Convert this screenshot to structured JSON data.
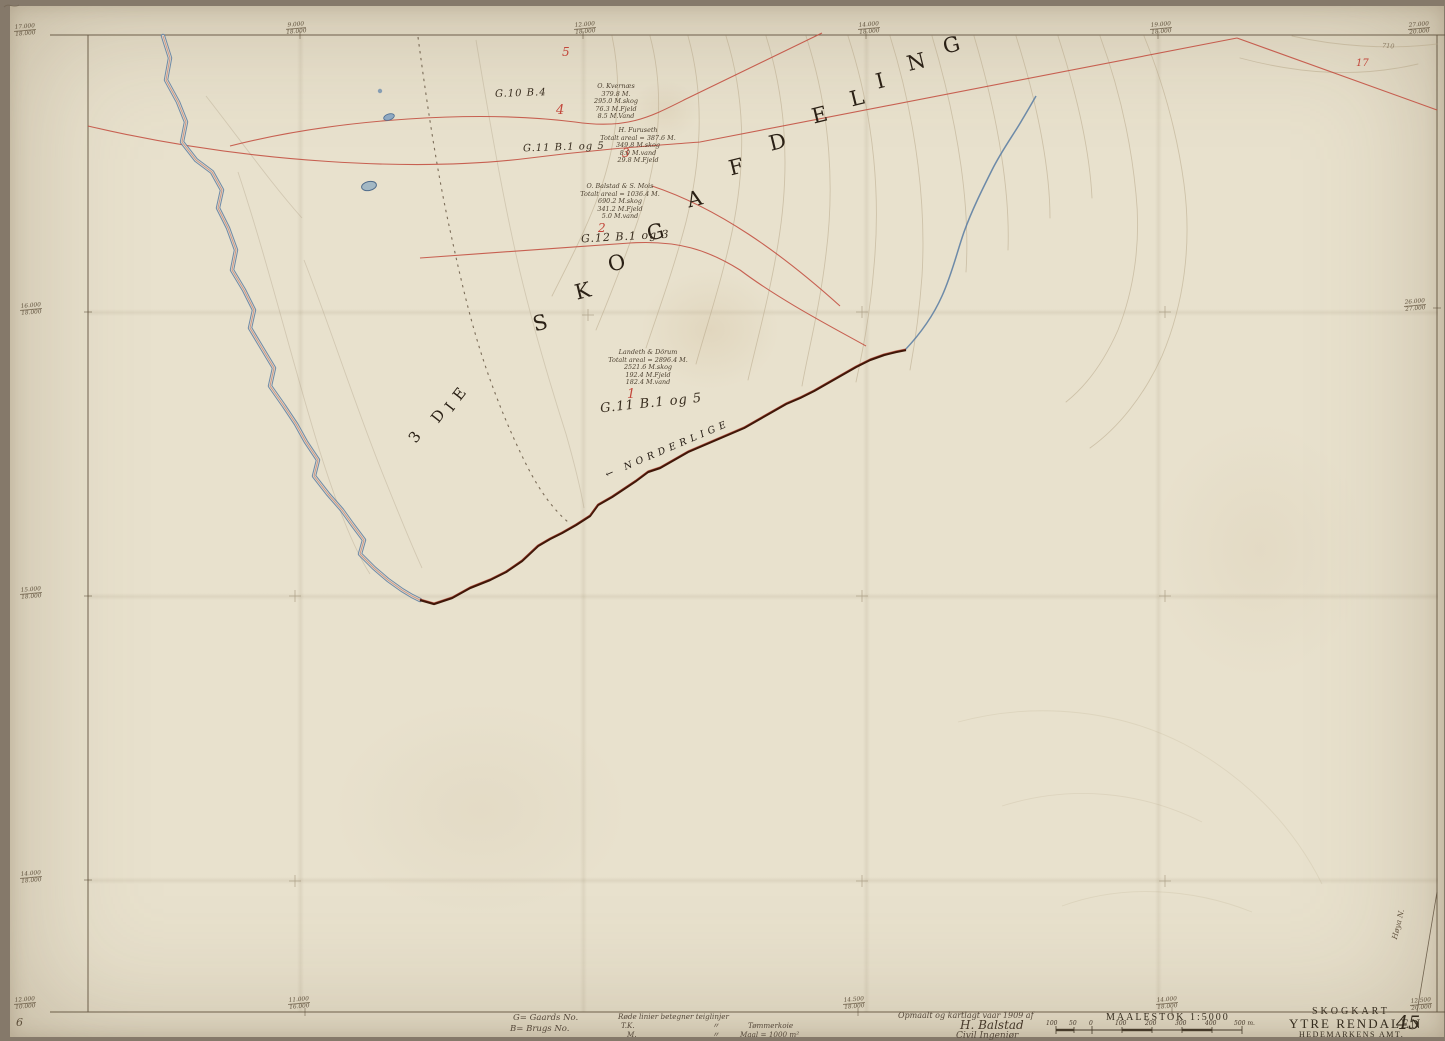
{
  "map": {
    "division_prefix": [
      {
        "ch": "3"
      },
      {
        "ch": "D"
      },
      {
        "ch": "I"
      },
      {
        "ch": "E"
      }
    ],
    "division_letters": [
      {
        "ch": "S"
      },
      {
        "ch": "K"
      },
      {
        "ch": "O"
      },
      {
        "ch": "G"
      },
      {
        "ch": "A"
      },
      {
        "ch": "F"
      },
      {
        "ch": "D"
      },
      {
        "ch": "E"
      },
      {
        "ch": "L"
      },
      {
        "ch": "I"
      },
      {
        "ch": "N"
      },
      {
        "ch": "G"
      }
    ],
    "boundary_label": {
      "arrow": "←",
      "text": "NORDERLIGE"
    },
    "codes": [
      {
        "text": "G.10 B.4"
      },
      {
        "text": "G.11 B.1 og 5"
      },
      {
        "text": "G.12 B.1 og 3"
      },
      {
        "text": "G.11 B.1 og 5"
      }
    ],
    "plot_numbers": [
      {
        "n": "5"
      },
      {
        "n": "4"
      },
      {
        "n": "3"
      },
      {
        "n": "2"
      },
      {
        "n": "1"
      },
      {
        "n": "17"
      }
    ],
    "owners": [
      {
        "lines": [
          "O. Kvernæs",
          "379.8 M.",
          "295.0 M.skog",
          "76.3 M.Fjeld",
          "8.5 M.Vand"
        ]
      },
      {
        "lines": [
          "H. Furuseth",
          "Totalt areal = 387.6 M.",
          "349.8 M.skog",
          "8.0 M.vand",
          "29.8 M.Fjeld"
        ]
      },
      {
        "lines": [
          "O. Balstad & S. Mois",
          "Totalt areal = 1036.4 M.",
          "690.2 M.skog",
          "341.2 M.Fjeld",
          "5.0 M.vand"
        ]
      },
      {
        "lines": [
          "Landeth & Dörum",
          "Totalt areal = 2896.4 M.",
          "2521.6 M.skog",
          "192.4 M.Fjeld",
          "182.4 M.vand"
        ]
      }
    ],
    "contour_label": "710",
    "side_note": "Høya N.",
    "corner_note": "6"
  },
  "edge_marks": [
    {
      "t": "17.000",
      "b": "18.000"
    },
    {
      "t": "9.000",
      "b": "18.000"
    },
    {
      "t": "12.000",
      "b": "18.000"
    },
    {
      "t": "14.000",
      "b": "18.000"
    },
    {
      "t": "19.000",
      "b": "18.000"
    },
    {
      "t": "27.000",
      "b": "20.000"
    },
    {
      "t": "16.000",
      "b": "18.000"
    },
    {
      "t": "15.000",
      "b": "18.000"
    },
    {
      "t": "14.000",
      "b": "18.000"
    },
    {
      "t": "26.000",
      "b": "27.000"
    },
    {
      "t": "12.000",
      "b": "10.000"
    },
    {
      "t": "11.000",
      "b": "16.000"
    },
    {
      "t": "14.500",
      "b": "18.000"
    },
    {
      "t": "14.000",
      "b": "18.000"
    },
    {
      "t": "12.500",
      "b": "20.000"
    }
  ],
  "legend": {
    "gaards_label": "G= Gaards No.",
    "brugs_label": "B= Brugs No.",
    "red_note": "Røde linier betegner teiglinjer",
    "tk_abbr": "T.K.",
    "m_abbr": "M.",
    "ditto": "〃",
    "tk_term": "Tømmerkoie",
    "m_term": "Maal = 1000 m²"
  },
  "survey": {
    "credit": "Opmaalt og kartlagt vaar 1909 af",
    "signature": "H. Balstad",
    "title": "Civil Ingeniør"
  },
  "scale": {
    "label": "MAALESTOK 1:5000",
    "ticks": [
      "100",
      "50",
      "0",
      "100",
      "200",
      "300",
      "400",
      "500 m."
    ]
  },
  "title_block": {
    "kind": "SKOGKART",
    "name": "YTRE RENDALEN",
    "region": "HEDEMARKENS AMT.",
    "sheet": "45"
  }
}
